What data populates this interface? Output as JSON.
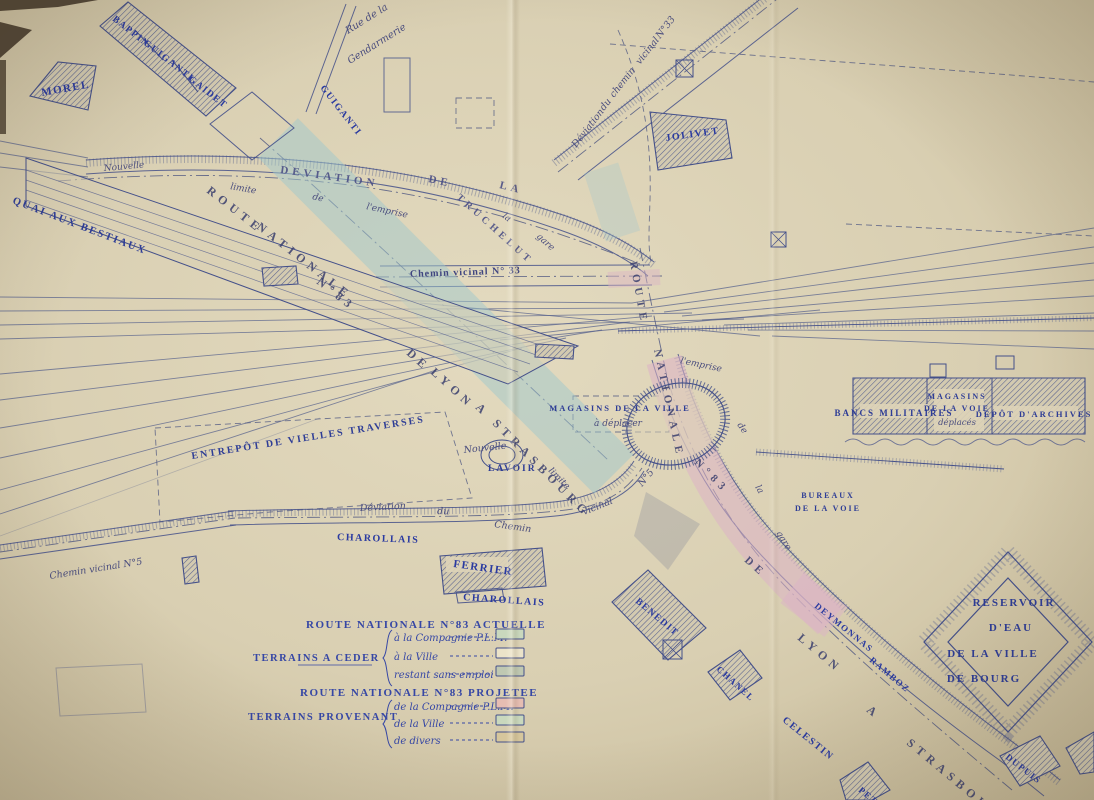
{
  "palette": {
    "paper_mid": "#d9cfb2",
    "paper_light": "#e3dabf",
    "paper_dark": "#c4b795",
    "ink": "#44508a",
    "rail": "#55608c",
    "hatch": "#57618f",
    "band_teal": "#9fc8cc",
    "band_pink": "#dcb3c6",
    "label_blue": "#2a3aa0",
    "script_blue": "#4a4d7e",
    "corner_dark": "#463b2b"
  },
  "labels": [
    [
      "MOREL",
      42,
      96,
      -10,
      11,
      "own"
    ],
    [
      "BAPPIN",
      112,
      20,
      38,
      9.5,
      "own"
    ],
    [
      "GUIGANTI",
      143,
      44,
      38,
      9.5,
      "own"
    ],
    [
      "GAIDET",
      188,
      80,
      38,
      9.5,
      "own"
    ],
    [
      "GUIGANTI",
      320,
      88,
      52,
      9.5,
      "own"
    ],
    [
      "JOLIVET",
      666,
      141,
      -8,
      10,
      "own"
    ],
    [
      "FERRIER",
      453,
      567,
      8,
      11,
      "own"
    ],
    [
      "BENEDIT",
      635,
      602,
      40,
      9.5,
      "own"
    ],
    [
      "CHANEL",
      716,
      670,
      42,
      9,
      "own"
    ],
    [
      "DUPUIS",
      1005,
      758,
      38,
      9,
      "own"
    ],
    [
      "DEYMONNAS",
      814,
      607,
      39,
      9,
      "own"
    ],
    [
      "RAMBOZ",
      869,
      661,
      40,
      9,
      "own"
    ],
    [
      "CELESTIN",
      782,
      721,
      39,
      10,
      "own"
    ],
    [
      "PETR",
      858,
      791,
      40,
      9,
      "own"
    ],
    [
      "CHAROLLAIS",
      337,
      540,
      2,
      10,
      "own"
    ],
    [
      "CHAROLLAIS",
      463,
      600,
      4,
      10,
      "own"
    ],
    [
      "QUAI  AUX  BESTIAUX",
      12,
      203,
      21,
      10.5,
      "cap"
    ],
    [
      "ENTREPÔT  DE  VIELLES  TRAVERSES",
      192,
      459,
      -9,
      10,
      "cap"
    ],
    [
      "MAGASINS  DE LA  VILLE",
      620,
      411,
      0,
      8.5,
      "cap",
      "m"
    ],
    [
      "à déplacer",
      618,
      426,
      0,
      9,
      "scr",
      "m"
    ],
    [
      "BANCS   MILITAIRES",
      894,
      416,
      0,
      9,
      "cap",
      "m"
    ],
    [
      "MAGASINS",
      957,
      399,
      0,
      8,
      "cap",
      "m"
    ],
    [
      "DE  LA  VOIE",
      957,
      411,
      0,
      8,
      "cap",
      "m"
    ],
    [
      "déplacés",
      957,
      425,
      0,
      8.5,
      "scr",
      "m"
    ],
    [
      "DEPÔT  D'ARCHIVES",
      1034,
      417,
      0,
      8.5,
      "cap",
      "m"
    ],
    [
      "BUREAUX",
      828,
      498,
      0,
      8,
      "cap",
      "m"
    ],
    [
      "DE LA VOIE",
      828,
      511,
      0,
      8,
      "cap",
      "m"
    ],
    [
      "RESERVOIR",
      1014,
      606,
      0,
      11,
      "cap",
      "m"
    ],
    [
      "D'EAU",
      1011,
      631,
      0,
      11,
      "cap",
      "m"
    ],
    [
      "DE  LA  VILLE",
      993,
      657,
      0,
      11,
      "cap",
      "m"
    ],
    [
      "DE  BOURG",
      984,
      682,
      0,
      11,
      "cap",
      "m"
    ],
    [
      "LAVOIR",
      488,
      471,
      0,
      9.5,
      "cap"
    ],
    [
      "ROUTE",
      206,
      192,
      38,
      12,
      "band"
    ],
    [
      "NATIONALE",
      256,
      228,
      38,
      12,
      "band"
    ],
    [
      "N°83",
      316,
      283,
      38,
      12,
      "band"
    ],
    [
      "DE",
      406,
      354,
      42,
      12,
      "band"
    ],
    [
      "LYON",
      430,
      373,
      42,
      12,
      "band"
    ],
    [
      "A",
      475,
      408,
      45,
      12,
      "band"
    ],
    [
      "STRASBOURG",
      492,
      424,
      45,
      12,
      "band"
    ],
    [
      "ROUTE",
      630,
      262,
      80,
      11,
      "band"
    ],
    [
      "NATIONALE",
      654,
      350,
      78,
      11,
      "band"
    ],
    [
      "N°83",
      694,
      463,
      45,
      11,
      "band"
    ],
    [
      "DE",
      744,
      561,
      42,
      11,
      "band"
    ],
    [
      "LYON",
      797,
      639,
      40,
      12,
      "band"
    ],
    [
      "A",
      866,
      711,
      40,
      12,
      "band"
    ],
    [
      "STRASBOURG",
      906,
      744,
      40,
      12,
      "band"
    ],
    [
      "DEVIATION",
      280,
      173,
      8,
      11,
      "road"
    ],
    [
      "DE",
      428,
      182,
      12,
      11,
      "road"
    ],
    [
      "LA",
      499,
      188,
      14,
      11,
      "road"
    ],
    [
      "TRUCHELUT",
      456,
      198,
      42,
      10,
      "road"
    ],
    [
      "Chemin  vicinal  N° 33",
      410,
      277,
      -2,
      10,
      "chem"
    ],
    [
      "Nouvelle",
      104,
      171,
      -5,
      9,
      "scr"
    ],
    [
      "limite",
      230,
      189,
      10,
      9,
      "scr"
    ],
    [
      "de",
      312,
      199,
      14,
      9,
      "scr"
    ],
    [
      "l'emprise",
      366,
      209,
      12,
      9,
      "scr"
    ],
    [
      "la",
      502,
      217,
      38,
      9,
      "scr"
    ],
    [
      "gare",
      536,
      237,
      42,
      9,
      "scr"
    ],
    [
      "Rue de la",
      348,
      34,
      -32,
      10,
      "scr"
    ],
    [
      "Gendarmerie",
      350,
      64,
      -32,
      10,
      "scr"
    ],
    [
      "Déviation",
      576,
      148,
      -52,
      9.5,
      "scr"
    ],
    [
      "du",
      604,
      111,
      -52,
      9.5,
      "scr"
    ],
    [
      "chemin",
      614,
      98,
      -52,
      9.5,
      "scr"
    ],
    [
      "vicinal",
      640,
      65,
      -52,
      9.5,
      "scr"
    ],
    [
      "N°33",
      660,
      39,
      -52,
      9.5,
      "scr"
    ],
    [
      "l'emprise",
      680,
      363,
      12,
      9,
      "scr"
    ],
    [
      "de",
      737,
      425,
      55,
      9,
      "scr"
    ],
    [
      "la",
      755,
      487,
      60,
      9,
      "scr"
    ],
    [
      "gare",
      776,
      533,
      58,
      9,
      "scr"
    ],
    [
      "limite",
      548,
      471,
      45,
      9,
      "scr"
    ],
    [
      "Nouvelle",
      464,
      453,
      -6,
      9.5,
      "scr"
    ],
    [
      "Déviation",
      360,
      511,
      -3,
      9.5,
      "scr"
    ],
    [
      "du",
      437,
      514,
      2,
      9.5,
      "scr"
    ],
    [
      "Chemin",
      494,
      527,
      8,
      9.5,
      "scr"
    ],
    [
      "vicinal",
      584,
      515,
      -22,
      9.5,
      "scr"
    ],
    [
      "N°5",
      642,
      487,
      -50,
      9.5,
      "scr"
    ],
    [
      "Chemin  vicinal  N°5",
      50,
      579,
      -9,
      9.5,
      "scr"
    ]
  ],
  "legend": {
    "titles": [
      {
        "t": "ROUTE  NATIONALE  N°83  ACTUELLE",
        "x": 306,
        "y": 628
      },
      {
        "t": "ROUTE  NATIONALE  N°83  PROJETEE",
        "x": 300,
        "y": 696
      }
    ],
    "item_x": 394,
    "swatch_x": 496,
    "swatch_w": 28,
    "swatch_h": 10,
    "groups": [
      {
        "label": "TERRAINS  A  CEDER",
        "x": 253,
        "y": 661,
        "brace": [
          388,
          630,
          686
        ],
        "items": [
          {
            "t": "à la Compagnie P.L.M.",
            "y": 641,
            "sw": "#c9d8bd"
          },
          {
            "t": "à la Ville",
            "y": 660,
            "sw": "#ebe3c9"
          },
          {
            "t": "restant sans emploi",
            "y": 678,
            "sw": "#bfc8b2"
          }
        ]
      },
      {
        "label": "TERRAINS  PROVENANT",
        "x": 248,
        "y": 720,
        "brace": [
          388,
          700,
          748
        ],
        "items": [
          {
            "t": "de la Compagnie P.L.M.",
            "y": 710,
            "sw": "#e6bdb2"
          },
          {
            "t": "de la Ville",
            "y": 727,
            "sw": "#c9d8bd"
          },
          {
            "t": "de divers",
            "y": 744,
            "sw": "#d6c69c"
          }
        ]
      }
    ]
  },
  "art": {
    "rails": [
      [
        0,
        297,
        632,
        303
      ],
      [
        0,
        311,
        648,
        308
      ],
      [
        0,
        325,
        692,
        313
      ],
      [
        0,
        339,
        744,
        319
      ],
      [
        0,
        374,
        652,
        316
      ],
      [
        0,
        400,
        630,
        322
      ],
      [
        0,
        428,
        602,
        330
      ],
      [
        0,
        458,
        566,
        338
      ],
      [
        0,
        490,
        522,
        348
      ],
      [
        0,
        514,
        436,
        370
      ],
      [
        0,
        141,
        88,
        158
      ],
      [
        0,
        153,
        88,
        167
      ],
      [
        0,
        167,
        88,
        177
      ],
      [
        632,
        303,
        1094,
        228
      ],
      [
        648,
        308,
        1094,
        247
      ],
      [
        664,
        312,
        1094,
        263
      ],
      [
        682,
        316,
        1094,
        280
      ],
      [
        702,
        320,
        1094,
        296
      ],
      [
        724,
        325,
        1094,
        313
      ],
      [
        748,
        330,
        1094,
        331
      ],
      [
        772,
        336,
        1094,
        349
      ],
      [
        420,
        303,
        760,
        336
      ],
      [
        500,
        340,
        820,
        310
      ]
    ],
    "faint": [
      [
        0,
        536,
        320,
        418
      ]
    ],
    "roads": [
      {
        "n": "road-deviation-truchelut",
        "e": [
          "M86,160 C280,146 430,170 566,216 C606,230 634,246 654,262",
          "M86,174 C280,160 428,184 560,230 C600,244 628,259 648,276"
        ],
        "t": "M86,160 C280,146 430,170 566,216 C606,230 634,246 654,262",
        "tw": 8
      },
      {
        "n": "road-rue-gendarmerie",
        "e": [
          "M346,4 L306,112",
          "M356,6 L316,114"
        ]
      },
      {
        "n": "road-deviation-chemin-33",
        "e": [
          "M554,160 L772,-10",
          "M578,180 L798,8"
        ],
        "t": "M554,160 L772,-10",
        "tw": 8
      },
      {
        "n": "road-chemin-vicinal-33",
        "e": [
          "M380,266 L650,265",
          "M380,287 L652,285"
        ]
      },
      {
        "n": "road-deviation-chemin-5",
        "e": [
          "M228,511 C360,507 482,511 562,501 C602,495 624,477 634,461",
          "M230,525 C360,521 482,525 564,515 C608,508 634,489 644,471"
        ],
        "t": "M228,511 C360,507 482,511 562,501 C602,495 624,477 634,461",
        "tw": 7
      },
      {
        "n": "road-rn83-projetee",
        "e": [
          "M652,360 C673,430 707,498 762,556 C822,620 902,690 1002,762 L1044,796",
          "M678,354 C698,424 731,490 785,546 C842,606 920,674 1018,746 L1060,780"
        ],
        "t": "M678,354 C698,424 731,490 785,546 C842,606 920,674 1018,746 L1060,780",
        "tw": 8
      },
      {
        "n": "road-chemin-vicinal-5-sw",
        "e": [
          "M0,545 L234,511",
          "M0,559 L236,525"
        ],
        "t": "M0,545 L234,511",
        "tw": 7
      }
    ],
    "dashdot": [
      "M58,181 C290,163 452,188 640,264",
      "M376,277 L662,276",
      "M640,248 C652,308 660,344 666,372 C688,458 731,530 787,588 C851,655 931,722 1012,790",
      "M558,172 L786,-8",
      "M238,518 C400,516 520,519 586,507 C616,499 630,485 642,468",
      "M260,138 C340,208 470,330 608,460",
      "M0,552 L235,518"
    ],
    "dashed": [
      "M155,428 L445,412 L472,498 L270,512 L160,522 Z",
      "M573,396 L669,396 L669,432 L573,432 Z",
      "M610,44 C780,58 960,70 1094,82",
      "M846,224 L1094,236",
      "M618,30 C640,80 652,130 650,200 C649,232 648,246 651,262",
      "M456,98 L494,98 L494,128 L456,128 Z"
    ],
    "bands": [
      {
        "n": "band-rn83-actuelle-teal",
        "d": "M278,138 L614,474",
        "w": 56,
        "c": "#9fc8cc",
        "o": 0.5
      },
      {
        "n": "band-teal-patch",
        "d": "M601,168 L623,236",
        "w": 36,
        "c": "#9fc8cc",
        "o": 0.3
      },
      {
        "n": "band-rn83-projetee-pink",
        "d": "M664,360 C684,432 716,500 764,554 C800,594 818,610 830,621",
        "w": 36,
        "c": "#dcb3c6",
        "o": 0.55
      },
      {
        "n": "band-pink-spur",
        "d": "M792,588 L836,622",
        "w": 38,
        "c": "#dcb3c6",
        "o": 0.5
      },
      {
        "n": "band-pink-crossing",
        "d": "M608,280 L660,277",
        "w": 16,
        "c": "#dcb3c6",
        "o": 0.45
      }
    ],
    "wedge": "M646,492 L700,524 L668,570 L634,536 Z",
    "hatched": [
      {
        "n": "building-morel",
        "d": "M30,96 L58,62 L96,66 L88,110 Z"
      },
      {
        "n": "building-row-bappin-guiganti-gaidet",
        "d": "M100,26 L128,2 L236,88 L206,116 Z"
      },
      {
        "n": "building-jolivet",
        "d": "M650,112 L726,120 L732,158 L658,170 Z"
      },
      {
        "n": "building-ferrier",
        "d": "M440,556 L542,548 L546,586 L444,594 Z"
      },
      {
        "n": "building-benedit",
        "d": "M612,602 L648,570 L706,628 L668,660 Z"
      },
      {
        "n": "building-chanel",
        "d": "M708,672 L740,650 L762,678 L730,700 Z"
      },
      {
        "n": "building-dupuis",
        "d": "M1000,756 L1040,736 L1060,766 L1020,786 Z"
      },
      {
        "n": "building-bancs-militaires-block",
        "d": "M853,378 L1085,378 L1085,434 L853,434 Z"
      },
      {
        "n": "building-petr",
        "d": "M840,780 L868,762 L890,790 L872,800 L846,800 Z"
      },
      {
        "n": "building-edge-right",
        "d": "M1066,748 L1094,732 L1094,772 L1080,774 Z"
      },
      {
        "n": "hatched-plot-1",
        "d": "M262,268 L296,266 L298,284 L264,286 Z"
      },
      {
        "n": "hatched-plot-2",
        "d": "M536,344 L574,346 L573,359 L535,357 Z"
      },
      {
        "n": "hatched-plot-3",
        "d": "M182,558 L196,556 L199,582 L185,584 Z"
      }
    ],
    "outlines": [
      {
        "n": "building-guiganti-2",
        "d": "M210,124 L252,92 L294,128 L252,160 Z",
        "o": 0.9
      },
      {
        "n": "building-annex",
        "d": "M384,58 L410,58 L410,112 L384,112 Z",
        "o": 0.8
      },
      {
        "n": "building-ferrier-annex",
        "d": "M456,592 L502,588 L504,600 L458,603 Z",
        "o": 0.9
      },
      {
        "n": "building-faint-sw",
        "d": "M56,668 L142,664 L146,712 L60,716 Z",
        "o": 0.35
      }
    ],
    "divlines": [
      [
        135,
        30,
        163,
        60
      ],
      [
        172,
        60,
        198,
        92
      ],
      [
        927,
        378,
        927,
        434
      ],
      [
        992,
        378,
        992,
        434
      ]
    ],
    "patches": [
      [
        860,
        404,
        68,
        14
      ],
      [
        934,
        389,
        50,
        42
      ],
      [
        994,
        406,
        84,
        14
      ],
      [
        446,
        557,
        62,
        15
      ]
    ],
    "squares": [
      [
        930,
        364,
        16,
        13
      ],
      [
        996,
        356,
        18,
        13
      ]
    ],
    "xsquares": [
      [
        676,
        60,
        17
      ],
      [
        663,
        640,
        19
      ],
      [
        771,
        232,
        15
      ]
    ],
    "shed": {
      "outline": "M26,158 L578,346 L508,384 L26,206 Z",
      "lines": [
        [
          26,
          170,
          560,
          352
        ],
        [
          26,
          180,
          545,
          358
        ],
        [
          26,
          190,
          530,
          364
        ],
        [
          26,
          200,
          518,
          372
        ]
      ]
    },
    "reservoir": {
      "outer": "M1008,552 L1092,642 L1008,732 L924,642 Z",
      "inner": "M1008,578 L1068,642 L1008,706 L948,642 Z"
    },
    "loop": {
      "cx": 676,
      "cy": 424,
      "rx": 50,
      "ry": 40,
      "rot": -18
    },
    "lavoir": [
      [
        502,
        455,
        21,
        15
      ],
      [
        502,
        455,
        13,
        9
      ]
    ],
    "walls": [
      {
        "n": "wall-quay",
        "d": "M756,452 L1004,469",
        "tw": 7
      },
      {
        "n": "wall-platform",
        "d": "M618,331 L1094,318",
        "tw": 6
      }
    ],
    "wavy": "M845,442 q8,-6 16,0 q8,6 16,0 q8,-6 16,0 q8,6 16,0 q8,-6 16,0 q8,6 16,0 q8,-6 16,0 q8,6 16,0 q8,-6 16,0 q8,6 16,0 q8,-6 16,0 q8,6 16,0 q8,-6 16,0 q8,6 16,0 q8,-6 16,0",
    "corners": [
      "M0,22 L32,30 L0,58 Z",
      "M0,0 L98,0 L58,7 L0,11 Z"
    ],
    "corner_rect": [
      0,
      60,
      6,
      74
    ],
    "creases": [
      {
        "x": 506,
        "w": 14,
        "o": 0.5
      },
      {
        "x": 768,
        "w": 12,
        "o": 0.25
      }
    ]
  }
}
